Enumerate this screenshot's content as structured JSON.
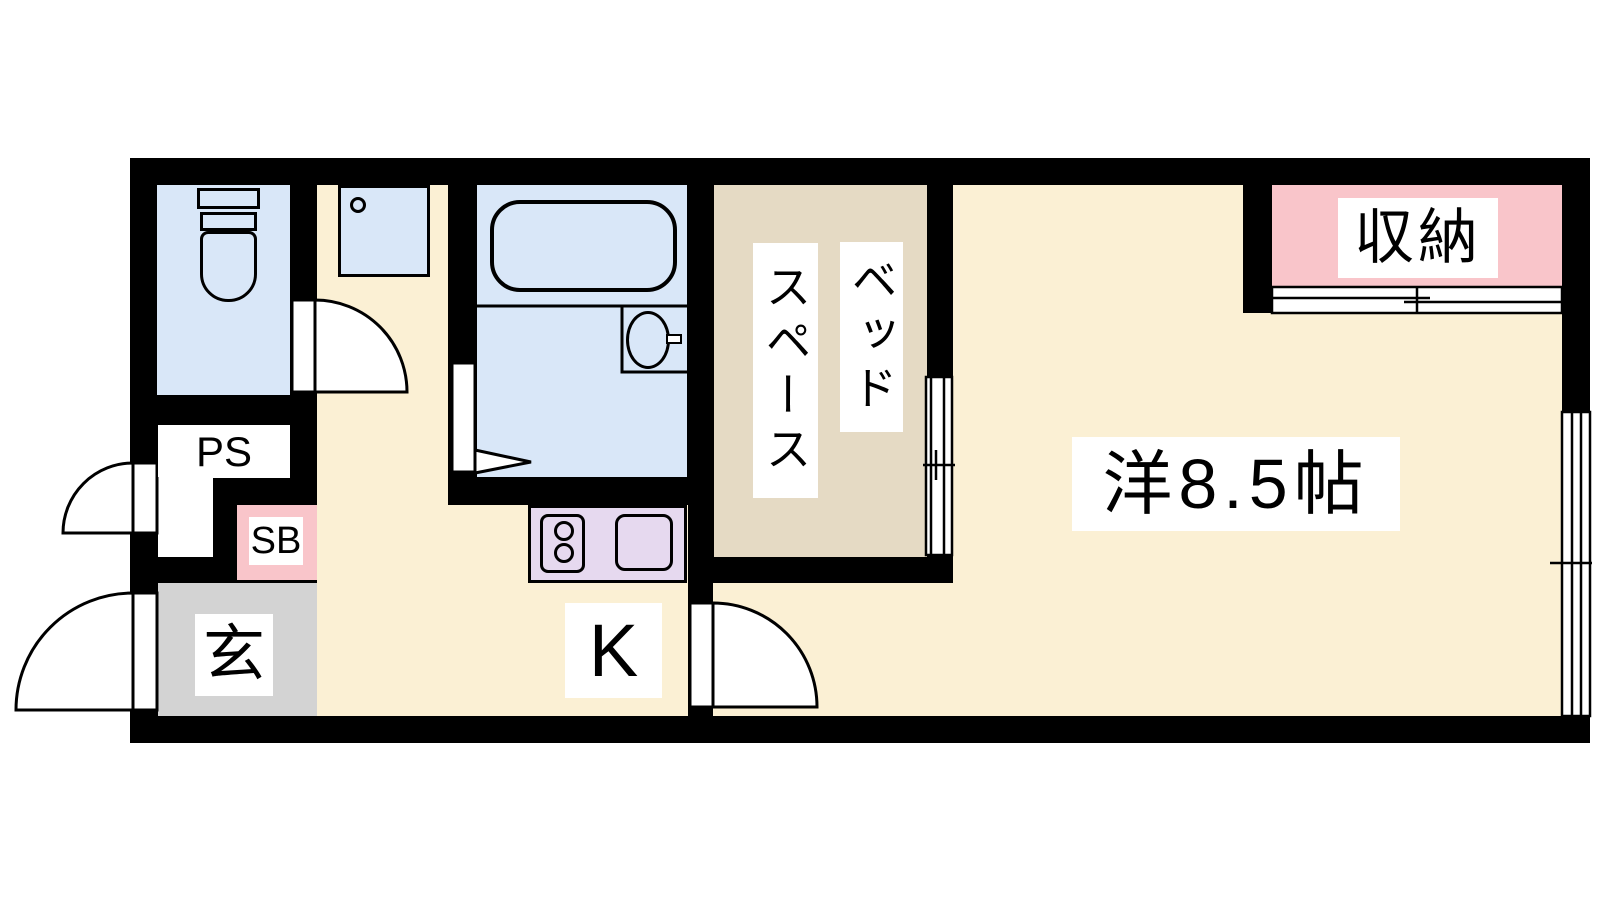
{
  "labels": {
    "pipe_space": "PS",
    "shoe_box": "SB",
    "entrance": "玄",
    "kitchen": "K",
    "bed_space_col_right": "ベッド",
    "bed_space_col_left": "スペース",
    "storage": "収納",
    "western_room": "洋8.5帖"
  },
  "colors": {
    "wall": "#000000",
    "line": "#000000",
    "floor": "#FBF0D4",
    "wet_area": "#D9E7F8",
    "bed_space": "#E5DAC4",
    "storage": "#F9C5CA",
    "kitchen_counter": "#E6D9EF",
    "entrance_floor": "#D3D3D3",
    "label_bg": "#FFFFFF"
  },
  "fixtures": {
    "toilet": "toilet",
    "washer_pan": "washing-machine-pan",
    "bathtub": "bathtub",
    "washbasin": "washbasin",
    "stove": "two-burner-stove",
    "kitchen_sink": "kitchen-sink",
    "window": "sliding-window",
    "doors": [
      "entrance-swing-door",
      "meter-box-door",
      "toilet-swing-door",
      "bathroom-folding-door",
      "kitchen-swing-door",
      "bed-space-sliding-door",
      "storage-sliding-door"
    ]
  }
}
